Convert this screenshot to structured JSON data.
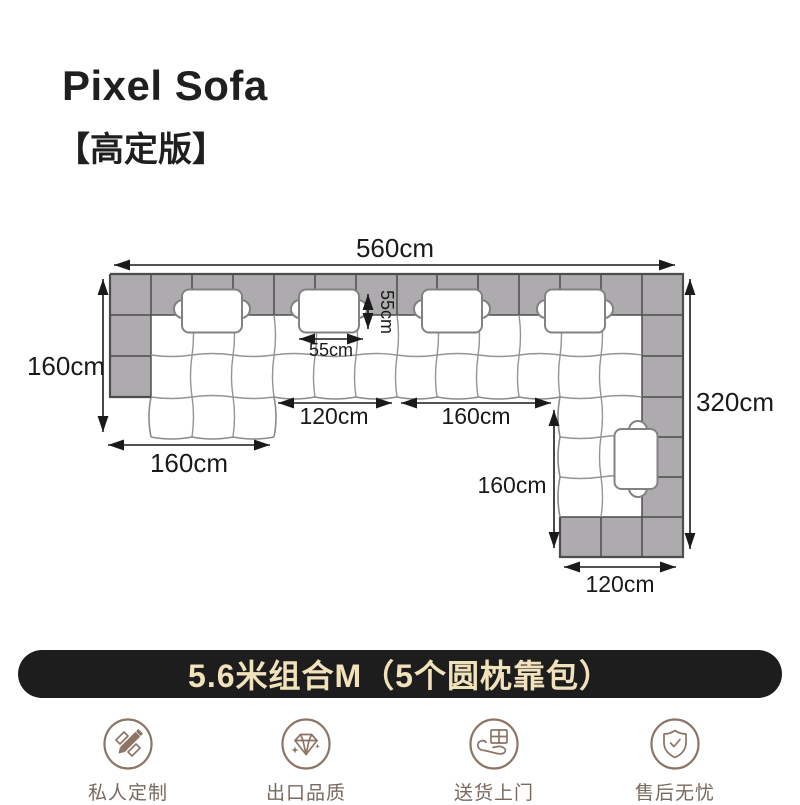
{
  "header": {
    "title": "Pixel Sofa",
    "subtitle": "【高定版】"
  },
  "diagram": {
    "unit": "cm",
    "dimensions": {
      "total_width": "560cm",
      "left_section_depth": "160cm",
      "right_section_length": "320cm",
      "left_chaise_width": "160cm",
      "middle_seat_span": "120cm",
      "right_seat_span": "160cm",
      "pillow_height": "55cm",
      "pillow_width": "55cm",
      "right_chaise_depth": "160cm",
      "right_chaise_width": "120cm"
    },
    "pillow_count": 5,
    "colors": {
      "backrest_gray": "#adabae",
      "grid_line": "#4d4d4d",
      "cushion_line": "#949494",
      "dimension_ink": "#1a1a1a"
    }
  },
  "banner": {
    "text": "5.6米组合M（5个圆枕靠包）",
    "background": "#1d1d1d",
    "text_color": "#f2e2bb"
  },
  "features": [
    {
      "icon": "pencil-ruler-icon",
      "label": "私人定制"
    },
    {
      "icon": "diamond-icon",
      "label": "出口品质"
    },
    {
      "icon": "hand-box-icon",
      "label": "送货上门"
    },
    {
      "icon": "shield-check-icon",
      "label": "售后无忧"
    }
  ]
}
